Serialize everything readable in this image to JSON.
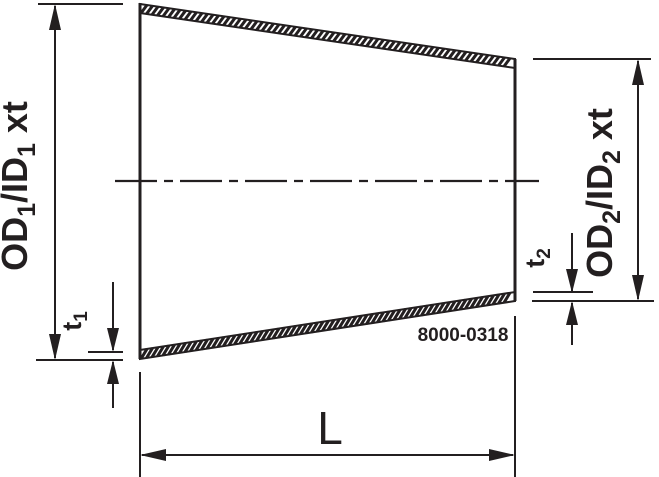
{
  "drawing": {
    "number": "8000-0318",
    "labels": {
      "left_diameter": {
        "p1": "OD",
        "s1": "1",
        "p2": "/ID",
        "s2": "1",
        "p3": " xt"
      },
      "right_diameter": {
        "p1": "OD",
        "s1": "2",
        "p2": "/ID",
        "s2": "2",
        "p3": " xt"
      },
      "left_thickness": {
        "p": "t",
        "s": "1"
      },
      "right_thickness": {
        "p": "t",
        "s": "2"
      },
      "length": "L"
    },
    "colors": {
      "ink": "#231f20",
      "background": "#ffffff"
    }
  }
}
